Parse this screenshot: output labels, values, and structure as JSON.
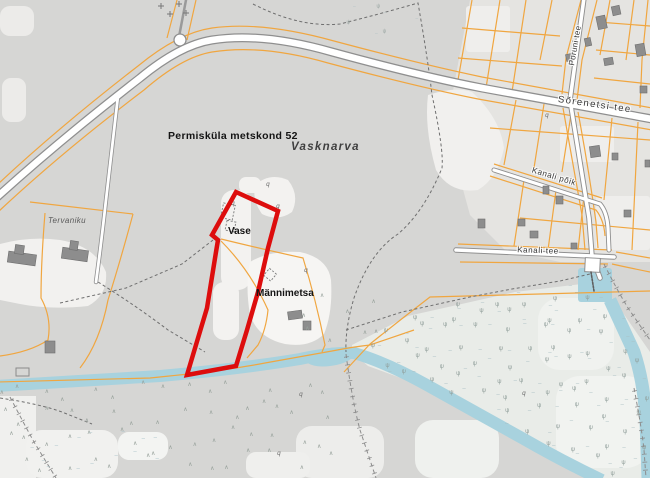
{
  "map": {
    "place_labels": {
      "forest_compartment": "Permisküla metskond 52",
      "village": "Vasknarva",
      "vase": "Vase",
      "mannimetsa": "Männimetsa",
      "tervaniku": "Tervaniku"
    },
    "road_labels": {
      "sorenetsi": "Sõrenetsi tee",
      "poruni": "Poruni tee",
      "kanali_poik": "Kanali põik",
      "kanali_tee": "Kanali tee"
    },
    "colors": {
      "land": "#d6d6d4",
      "clearing": "#f3f2f0",
      "wetland": "#e9ece8",
      "water": "#a8d2de",
      "cadastral_line": "#f0a640",
      "road_fill": "#ffffff",
      "road_casing": "#8f8f8f",
      "building": "#8d8d8d",
      "selected_parcel_outline": "#dd0d0d",
      "path_dashed": "#6f6f6f"
    },
    "symbol_regions": [
      {
        "name": "scrub-symbols",
        "glyphs": [
          "∧"
        ],
        "colors": [
          "#96a09a"
        ],
        "font": 6,
        "rect": [
          2,
          392,
          340,
          84
        ],
        "step": 23,
        "seed": 7
      },
      {
        "name": "scrub-symbols-2",
        "glyphs": [
          "∧"
        ],
        "colors": [
          "#96a09a"
        ],
        "font": 6,
        "rect": [
          300,
          306,
          86,
          42
        ],
        "step": 27,
        "seed": 11
      },
      {
        "name": "marsh-symbols",
        "glyphs": [
          "–",
          "ψ"
        ],
        "colors": [
          "#aabfc3",
          "#8f9d99"
        ],
        "font": 6,
        "poly": [
          [
            352,
            345
          ],
          [
            408,
            316
          ],
          [
            515,
            292
          ],
          [
            590,
            283
          ],
          [
            614,
            300
          ],
          [
            650,
            352
          ],
          [
            650,
            478
          ],
          [
            600,
            478
          ],
          [
            545,
            452
          ],
          [
            480,
            416
          ],
          [
            420,
            385
          ],
          [
            368,
            366
          ],
          [
            352,
            352
          ]
        ],
        "step": 16,
        "seed": 3
      },
      {
        "name": "marsh-dash-patch",
        "glyphs": [
          "–"
        ],
        "colors": [
          "#a9c2c8"
        ],
        "font": 6,
        "rect": [
          34,
          440,
          76,
          30
        ],
        "step": 22,
        "seed": 5
      },
      {
        "name": "marsh-dash-patch-2",
        "glyphs": [
          "–"
        ],
        "colors": [
          "#a9c2c8"
        ],
        "font": 6,
        "rect": [
          122,
          436,
          42,
          20
        ],
        "step": 18,
        "seed": 9
      },
      {
        "name": "sparse-marsh-top",
        "glyphs": [
          "–",
          "ψ"
        ],
        "colors": [
          "#b3c3c3",
          "#9aa6a2"
        ],
        "font": 5,
        "rect": [
          350,
          6,
          64,
          26
        ],
        "step": 21,
        "seed": 13
      }
    ]
  }
}
